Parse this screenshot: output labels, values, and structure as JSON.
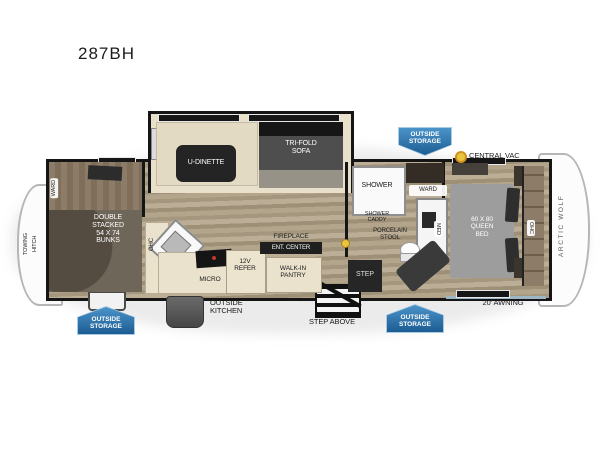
{
  "title": "287BH",
  "brand": "ARCTIC WOLF",
  "exterior": {
    "outside_storage": "OUTSIDE\nSTORAGE",
    "central_vac": "CENTRAL VAC",
    "awning": "20' AWNING",
    "step_above": "STEP ABOVE",
    "outside_kitchen": "OUTSIDE\nKITCHEN",
    "towing_hitch": "TOWING\nHITCH"
  },
  "living_area": {
    "u_dinette": "U-DINETTE",
    "tri_fold_sofa": "TRI-FOLD\nSOFA",
    "ohc": "OHC",
    "micro": "MICRO",
    "refer": "12V\nREFER",
    "fireplace": "FIREPLACE",
    "ent_center": "ENT. CENTER",
    "walk_in_pantry": "WALK-IN\nPANTRY"
  },
  "bunk_room": {
    "ward": "WARD",
    "bunks": "DOUBLE\nSTACKED\n54 X 74\nBUNKS"
  },
  "bathroom": {
    "shower": "SHOWER",
    "shower_caddy": "SHOWER\nCADDY",
    "porcelain_stool": "PORCELAIN\nSTOOL",
    "ward": "WARD",
    "med": "MED",
    "step": "STEP"
  },
  "bedroom": {
    "queen_bed": "60 X 80\nQUEEN\nBED",
    "ohc": "OHC"
  },
  "colors": {
    "badge_blue": "#2f6ea8",
    "vac_yellow": "#e9c53d"
  }
}
